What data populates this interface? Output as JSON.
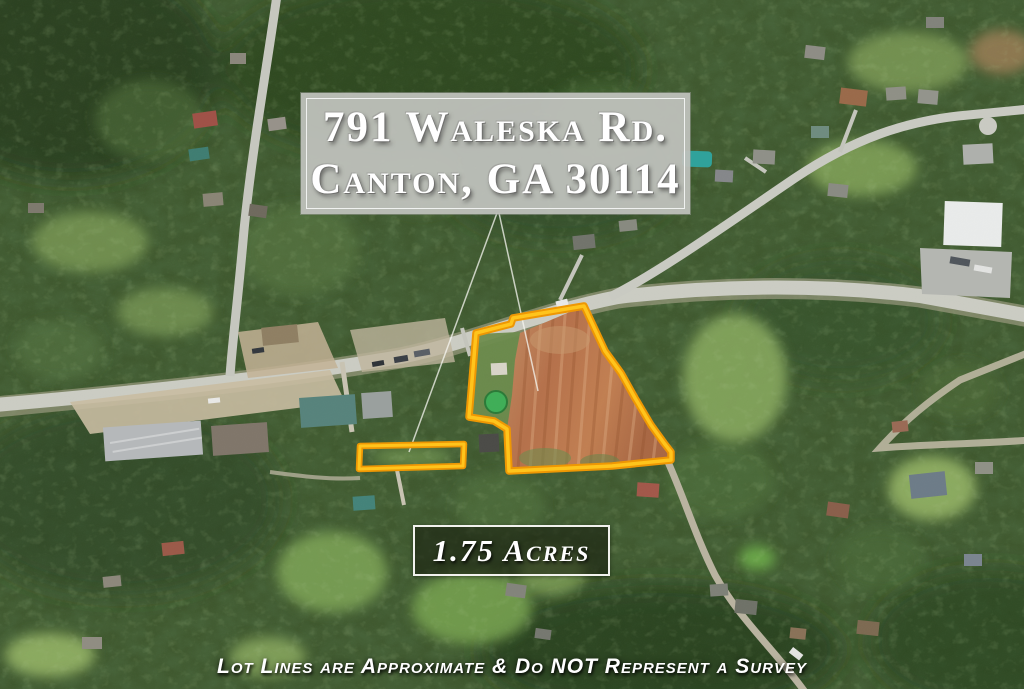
{
  "address_box": {
    "line1": "791 Waleska Rd.",
    "line2": "Canton, GA 30114"
  },
  "acreage_box": {
    "value": "1.75 Acres"
  },
  "disclaimer": {
    "text": "Lot Lines are Approximate & Do NOT Represent a Survey"
  },
  "lot_outline": {
    "stroke_outer": "#EE9704",
    "stroke_inner": "#FFC61E",
    "leader_color": "#f7f7f2",
    "main_parcel_points": "476,333 511,324 513,318 584,306 605,351 621,373 635,398 651,425 664,443 671,452 671,460 612,466 509,471 507,429 494,421 469,417",
    "strip_parcel_points": "360,446 464,444 463,466 359,469",
    "leader_line_left": "M497,213 L409,452",
    "leader_line_right": "M499,213 L538,391"
  }
}
